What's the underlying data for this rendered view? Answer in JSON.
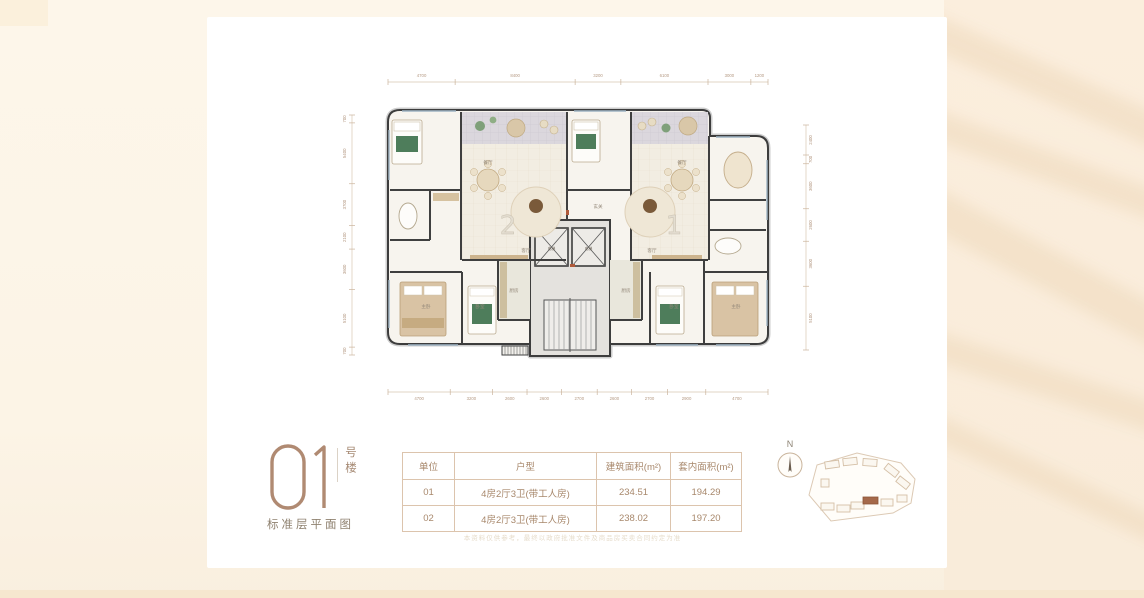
{
  "title_block": {
    "building_number": "01",
    "building_suffix": "号楼",
    "caption": "标准层平面图"
  },
  "table": {
    "headers": [
      "单位",
      "户型",
      "建筑面积(m²)",
      "套内面积(m²)"
    ],
    "rows": [
      [
        "01",
        "4房2厅3卫(带工人房)",
        "234.51",
        "194.29"
      ],
      [
        "02",
        "4房2厅3卫(带工人房)",
        "238.02",
        "197.20"
      ]
    ]
  },
  "compass": {
    "label": "N"
  },
  "disclaimer": "本资料仅供参考，最终以政府批准文件及商品房买卖合同约定为准",
  "plan": {
    "unit_labels": [
      {
        "text": "2",
        "x": 178,
        "y": 174
      },
      {
        "text": "1",
        "x": 344,
        "y": 174
      }
    ],
    "elevator_label": "电梯",
    "room_labels": [
      {
        "text": "主卧",
        "x": 96,
        "y": 248
      },
      {
        "text": "卧室",
        "x": 150,
        "y": 248
      },
      {
        "text": "客厅",
        "x": 196,
        "y": 192
      },
      {
        "text": "餐厅",
        "x": 158,
        "y": 104
      },
      {
        "text": "厨房",
        "x": 184,
        "y": 232
      },
      {
        "text": "玄关",
        "x": 268,
        "y": 148
      },
      {
        "text": "客厅",
        "x": 322,
        "y": 192
      },
      {
        "text": "餐厅",
        "x": 352,
        "y": 104
      },
      {
        "text": "厨房",
        "x": 296,
        "y": 232
      },
      {
        "text": "卧室",
        "x": 344,
        "y": 248
      },
      {
        "text": "主卧",
        "x": 406,
        "y": 248
      }
    ],
    "dimensions": {
      "top": [
        "4700",
        "8400",
        "3200",
        "6100",
        "3000",
        "1200"
      ],
      "bottom": [
        "4700",
        "3200",
        "2600",
        "2600",
        "2700",
        "2600",
        "2700",
        "2900",
        "4700"
      ],
      "left": [
        "700",
        "5400",
        "3700",
        "2100",
        "3600",
        "5100",
        "700"
      ],
      "right": [
        "2400",
        "700",
        "3600",
        "2600",
        "3600",
        "5100"
      ]
    }
  }
}
